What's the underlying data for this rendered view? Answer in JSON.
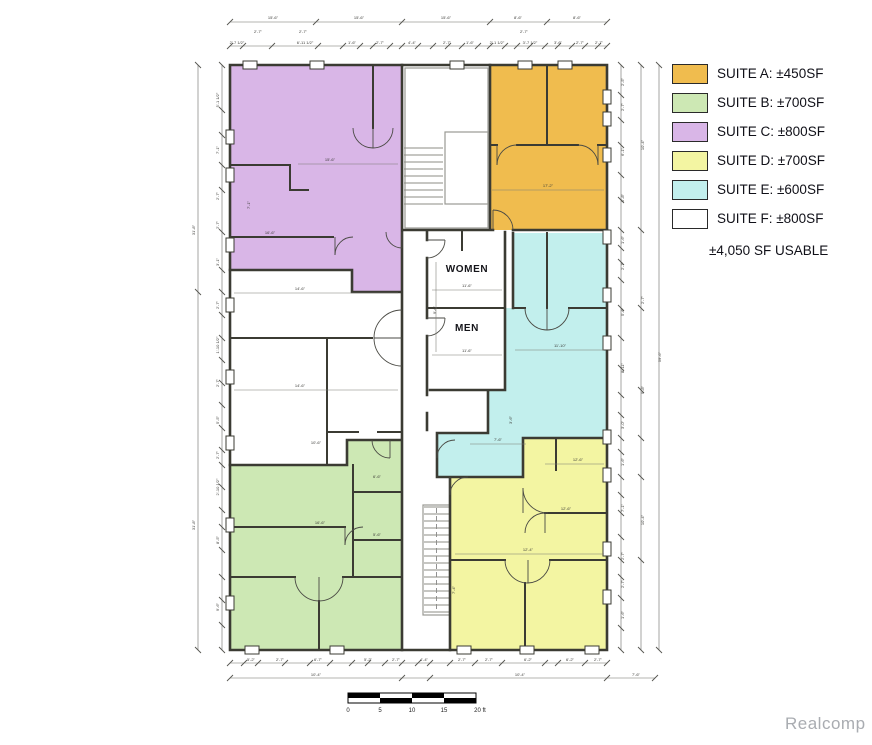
{
  "legend": {
    "items": [
      {
        "suite": "A",
        "label": "SUITE A: ±450SF",
        "color": "#F0BC4E"
      },
      {
        "suite": "B",
        "label": "SUITE B: ±700SF",
        "color": "#CDE8B4"
      },
      {
        "suite": "C",
        "label": "SUITE C: ±800SF",
        "color": "#D9B6E7"
      },
      {
        "suite": "D",
        "label": "SUITE D: ±700SF",
        "color": "#F3F5A2"
      },
      {
        "suite": "E",
        "label": "SUITE E: ±600SF",
        "color": "#C2EFED"
      },
      {
        "suite": "F",
        "label": "SUITE F: ±800SF",
        "color": "#FFFFFF"
      }
    ],
    "total_label": "±4,050 SF USABLE"
  },
  "plan": {
    "room_labels": {
      "women": "WOMEN",
      "men": "MEN"
    },
    "dimensions": [
      {
        "t": "15'-6\"",
        "x": 273,
        "y": 19
      },
      {
        "t": "15'-6\"",
        "x": 359,
        "y": 19
      },
      {
        "t": "15'-6\"",
        "x": 446,
        "y": 19
      },
      {
        "t": "8'-6\"",
        "x": 518,
        "y": 19
      },
      {
        "t": "8'-6\"",
        "x": 577,
        "y": 19
      },
      {
        "t": "2'-7\"",
        "x": 258,
        "y": 33
      },
      {
        "t": "2'-7\"",
        "x": 303,
        "y": 33
      },
      {
        "t": "2'-7\"",
        "x": 524,
        "y": 33
      },
      {
        "t": "2'-7 1/2\"",
        "x": 237,
        "y": 44
      },
      {
        "t": "6'-11 1/2\"",
        "x": 305,
        "y": 44
      },
      {
        "t": "1'-6\"",
        "x": 352,
        "y": 44
      },
      {
        "t": "2'-7\"",
        "x": 380,
        "y": 44
      },
      {
        "t": "4'-4\"",
        "x": 412,
        "y": 44
      },
      {
        "t": "2'-7\"",
        "x": 447,
        "y": 44
      },
      {
        "t": "1'-6\"",
        "x": 470,
        "y": 44
      },
      {
        "t": "2'-1 1/2\"",
        "x": 497,
        "y": 44
      },
      {
        "t": "3'-7 1/2\"",
        "x": 530,
        "y": 44
      },
      {
        "t": "3'-6\"",
        "x": 558,
        "y": 44
      },
      {
        "t": "2'-7\"",
        "x": 580,
        "y": 44
      },
      {
        "t": "2'-7\"",
        "x": 599,
        "y": 44
      },
      {
        "t": "5'-2\"",
        "x": 251,
        "y": 661
      },
      {
        "t": "2'-7\"",
        "x": 280,
        "y": 661
      },
      {
        "t": "6'-7\"",
        "x": 318,
        "y": 661
      },
      {
        "t": "5'-2\"",
        "x": 368,
        "y": 661
      },
      {
        "t": "2'-7\"",
        "x": 396,
        "y": 661
      },
      {
        "t": "4'-4\"",
        "x": 424,
        "y": 661
      },
      {
        "t": "2'-7\"",
        "x": 462,
        "y": 661
      },
      {
        "t": "2'-7\"",
        "x": 489,
        "y": 661
      },
      {
        "t": "6'-2\"",
        "x": 528,
        "y": 661
      },
      {
        "t": "6'-2\"",
        "x": 570,
        "y": 661
      },
      {
        "t": "2'-7\"",
        "x": 598,
        "y": 661
      },
      {
        "t": "10'-4\"",
        "x": 316,
        "y": 676
      },
      {
        "t": "10'-4\"",
        "x": 520,
        "y": 676
      },
      {
        "t": "7'-6\"",
        "x": 636,
        "y": 676
      },
      {
        "t": "31'-8\"",
        "x": 195,
        "y": 230,
        "r": -90
      },
      {
        "t": "31'-8\"",
        "x": 195,
        "y": 525,
        "r": -90
      },
      {
        "t": "5'-1 1/2\"",
        "x": 219,
        "y": 100,
        "r": -90
      },
      {
        "t": "7'-1\"",
        "x": 219,
        "y": 150,
        "r": -90
      },
      {
        "t": "2'-7\"",
        "x": 219,
        "y": 196,
        "r": -90
      },
      {
        "t": "2'-7\"",
        "x": 219,
        "y": 225,
        "r": -90
      },
      {
        "t": "3'-1\"",
        "x": 219,
        "y": 262,
        "r": -90
      },
      {
        "t": "2'-7\"",
        "x": 219,
        "y": 305,
        "r": -90
      },
      {
        "t": "1'-10 1/2\"",
        "x": 219,
        "y": 345,
        "r": -90
      },
      {
        "t": "2'-7\"",
        "x": 219,
        "y": 383,
        "r": -90
      },
      {
        "t": "5'-5\"",
        "x": 219,
        "y": 420,
        "r": -90
      },
      {
        "t": "2'-7\"",
        "x": 219,
        "y": 455,
        "r": -90
      },
      {
        "t": "2'-10 1/2\"",
        "x": 219,
        "y": 487,
        "r": -90
      },
      {
        "t": "8'-5\"",
        "x": 219,
        "y": 540,
        "r": -90
      },
      {
        "t": "9'-6\"",
        "x": 219,
        "y": 607,
        "r": -90
      },
      {
        "t": "2'-5\"",
        "x": 624,
        "y": 82,
        "r": -90
      },
      {
        "t": "2'-7\"",
        "x": 624,
        "y": 107,
        "r": -90
      },
      {
        "t": "6'-1\"",
        "x": 624,
        "y": 152,
        "r": -90
      },
      {
        "t": "5'-8\"",
        "x": 624,
        "y": 198,
        "r": -90
      },
      {
        "t": "1'-6\"",
        "x": 624,
        "y": 240,
        "r": -90
      },
      {
        "t": "2'-7\"",
        "x": 624,
        "y": 266,
        "r": -90
      },
      {
        "t": "5'-6\"",
        "x": 624,
        "y": 312,
        "r": -90
      },
      {
        "t": "8'-11\"",
        "x": 624,
        "y": 368,
        "r": -90
      },
      {
        "t": "3'-0\"",
        "x": 624,
        "y": 425,
        "r": -90
      },
      {
        "t": "1'-6\"",
        "x": 624,
        "y": 462,
        "r": -90
      },
      {
        "t": "7'-1\"",
        "x": 624,
        "y": 508,
        "r": -90
      },
      {
        "t": "2'-7\"",
        "x": 624,
        "y": 556,
        "r": -90
      },
      {
        "t": "2'-7\"",
        "x": 624,
        "y": 584,
        "r": -90
      },
      {
        "t": "1'-6\"",
        "x": 624,
        "y": 615,
        "r": -90
      },
      {
        "t": "10'-4\"",
        "x": 644,
        "y": 145,
        "r": -90
      },
      {
        "t": "2'-7\"",
        "x": 644,
        "y": 300,
        "r": -90
      },
      {
        "t": "9'-8\"",
        "x": 644,
        "y": 390,
        "r": -90
      },
      {
        "t": "10'-4\"",
        "x": 644,
        "y": 520,
        "r": -90
      },
      {
        "t": "59'-6\"",
        "x": 661,
        "y": 357,
        "r": -90
      },
      {
        "t": "15'-6\"",
        "x": 330,
        "y": 161
      },
      {
        "t": "16'-6\"",
        "x": 270,
        "y": 234
      },
      {
        "t": "17'-2\"",
        "x": 548,
        "y": 187
      },
      {
        "t": "14'-6\"",
        "x": 300,
        "y": 290
      },
      {
        "t": "14'-6\"",
        "x": 300,
        "y": 387
      },
      {
        "t": "11'-6\"",
        "x": 467,
        "y": 287
      },
      {
        "t": "11'-6\"",
        "x": 467,
        "y": 352
      },
      {
        "t": "11'-10\"",
        "x": 560,
        "y": 347
      },
      {
        "t": "7'-6\"",
        "x": 498,
        "y": 441
      },
      {
        "t": "16'-6\"",
        "x": 320,
        "y": 524
      },
      {
        "t": "6'-6\"",
        "x": 377,
        "y": 478
      },
      {
        "t": "5'-6\"",
        "x": 377,
        "y": 536
      },
      {
        "t": "12'-6\"",
        "x": 566,
        "y": 510
      },
      {
        "t": "12'-4\"",
        "x": 528,
        "y": 551
      },
      {
        "t": "12'-6\"",
        "x": 578,
        "y": 461
      },
      {
        "t": "10'-6\"",
        "x": 316,
        "y": 444
      },
      {
        "t": "9'-6\"",
        "x": 436,
        "y": 310,
        "r": -90
      },
      {
        "t": "7'-4\"",
        "x": 455,
        "y": 590,
        "r": -90
      },
      {
        "t": "3'-6\"",
        "x": 512,
        "y": 420,
        "r": -90
      },
      {
        "t": "7'-1\"",
        "x": 250,
        "y": 205,
        "r": -90
      }
    ]
  },
  "scale_bar": {
    "labels": [
      "0",
      "5",
      "10",
      "15",
      "20 ft"
    ]
  },
  "watermark": "Realcomp"
}
